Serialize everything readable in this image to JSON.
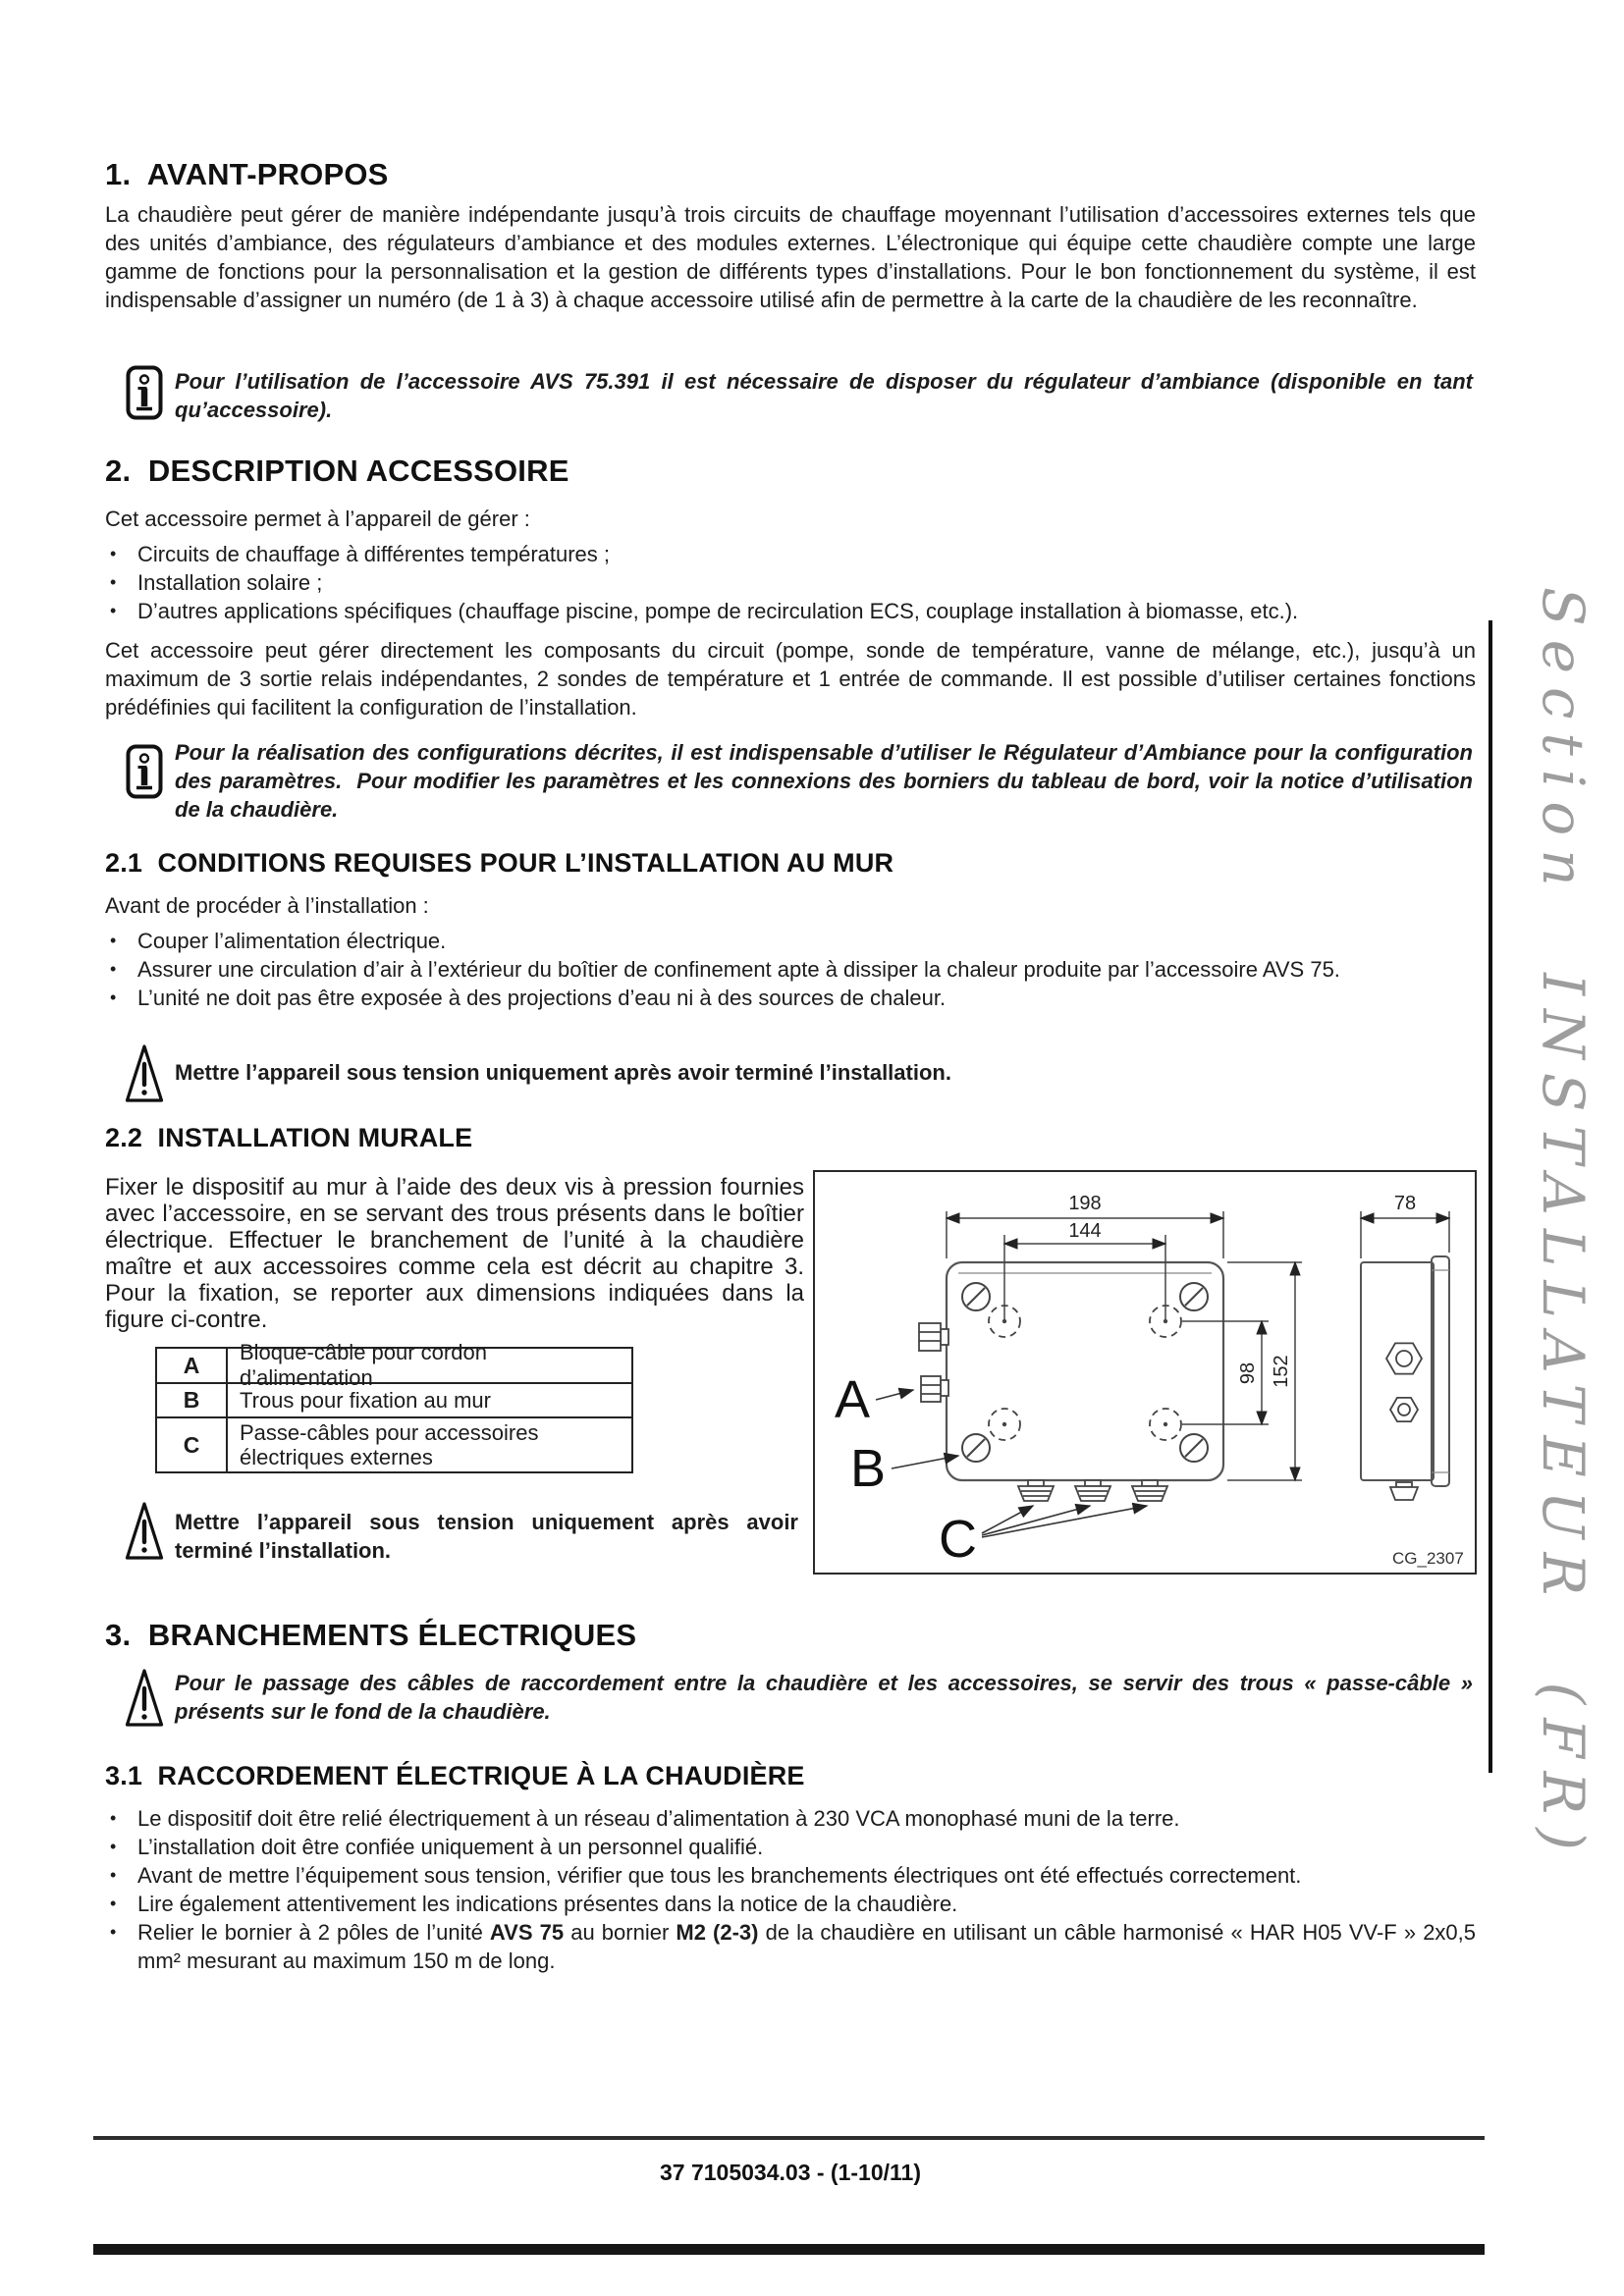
{
  "page": {
    "footer": "37 7105034.03 - (1-10/11)",
    "side_label": "Section INSTALLATEUR (FR)"
  },
  "s1": {
    "title": "1.  AVANT-PROPOS",
    "body": "La chaudière peut gérer de manière indépendante jusqu’à trois circuits de chauffage moyennant l’utilisation d’accessoires externes tels que des unités d’ambiance, des régulateurs d’ambiance et des modules externes. L’électronique qui équipe cette chaudière compte une large gamme de fonctions pour la personnalisation et la gestion de différents types d’installations.  Pour le bon fonctionnement du système, il est indispensable d’assigner un numéro (de 1 à 3) à chaque accessoire utilisé afin de permettre à la carte de la chaudière de les reconnaître."
  },
  "note1": {
    "text": "Pour l’utilisation de l’accessoire AVS 75.391 il est nécessaire de disposer du régulateur d’ambiance (disponible en tant qu’accessoire)."
  },
  "s2": {
    "title": "2.  DESCRIPTION ACCESSOIRE",
    "intro": "Cet accessoire permet à l’appareil de gérer :",
    "bullets": [
      "Circuits de chauffage à différentes températures ;",
      "Installation solaire ;",
      "D’autres applications spécifiques (chauffage piscine, pompe de recirculation ECS, couplage installation à biomasse, etc.)."
    ],
    "body": "Cet accessoire peut gérer directement les composants du circuit (pompe, sonde de température, vanne de mélange, etc.), jusqu’à un maximum de 3 sortie relais indépendantes, 2 sondes de température et 1 entrée de commande.  Il est possible d’utiliser certaines fonctions prédéfinies qui facilitent la configuration de l’installation."
  },
  "note2": {
    "text": "Pour la réalisation des configurations décrites, il est indispensable d’utiliser le Régulateur d’Ambiance pour la configuration des paramètres.  Pour modifier les paramètres et les connexions des borniers du tableau de bord, voir la notice d’utilisation de la chaudière."
  },
  "s21": {
    "title": "2.1  CONDITIONS REQUISES POUR L’INSTALLATION AU MUR",
    "intro": "Avant de procéder à l’installation :",
    "bullets": [
      "Couper l’alimentation électrique.",
      "Assurer une circulation d’air à l’extérieur du boîtier de confinement apte à dissiper la chaleur produite par l’accessoire AVS 75.",
      "L’unité ne doit pas être exposée à des projections d’eau ni à des sources de chaleur."
    ]
  },
  "warn1": {
    "text": "Mettre l’appareil sous tension uniquement après avoir terminé l’installation."
  },
  "s22": {
    "title": "2.2  INSTALLATION MURALE",
    "body": "Fixer le dispositif au mur à l’aide des deux vis à pression fournies avec l’accessoire, en se servant des trous présents dans le boîtier électrique. Effectuer le branchement de l’unité à la chaudière maître et aux accessoires comme cela est décrit au chapitre 3. Pour la fixation, se reporter aux dimensions indiquées dans la figure ci-contre.",
    "legend": [
      {
        "key": "A",
        "text": "Bloque-câble pour cordon d’alimentation"
      },
      {
        "key": "B",
        "text": "Trous pour fixation au mur"
      },
      {
        "key": "C",
        "text": "Passe-câbles pour accessoires électriques externes"
      }
    ]
  },
  "warn2": {
    "text": "Mettre l’appareil sous tension uniquement après avoir terminé l’installation."
  },
  "figure": {
    "dim_top_outer": "198",
    "dim_top_inner": "144",
    "dim_side": "78",
    "dim_right_inner": "98",
    "dim_right_outer": "152",
    "label_a": "A",
    "label_b": "B",
    "label_c": "C",
    "code": "CG_2307"
  },
  "s3": {
    "title": "3.  BRANCHEMENTS ÉLECTRIQUES"
  },
  "warn3": {
    "text": "Pour le passage des câbles de raccordement entre la chaudière et les accessoires, se servir des trous « passe-câble » présents sur le fond de la chaudière."
  },
  "s31": {
    "title": "3.1  RACCORDEMENT ÉLECTRIQUE À LA CHAUDIÈRE",
    "bullets": [
      "Le dispositif doit être relié électriquement à un réseau d’alimentation à 230 VCA monophasé muni de la terre.",
      "L’installation doit être confiée uniquement à un personnel qualifié.",
      "Avant de mettre l’équipement sous tension, vérifier que tous les branchements électriques ont été effectués correctement.",
      "Lire également attentivement les indications présentes dans la notice de la chaudière."
    ],
    "bullet5": {
      "pre": "Relier le bornier à 2 pôles de l’unité ",
      "b1": "AVS 75",
      "mid": " au bornier ",
      "b2": "M2 (2-3)",
      "post": " de la chaudière en utilisant un câble harmonisé « HAR H05 VV-F » 2x0,5 mm² mesurant au maximum 150 m de long."
    }
  }
}
